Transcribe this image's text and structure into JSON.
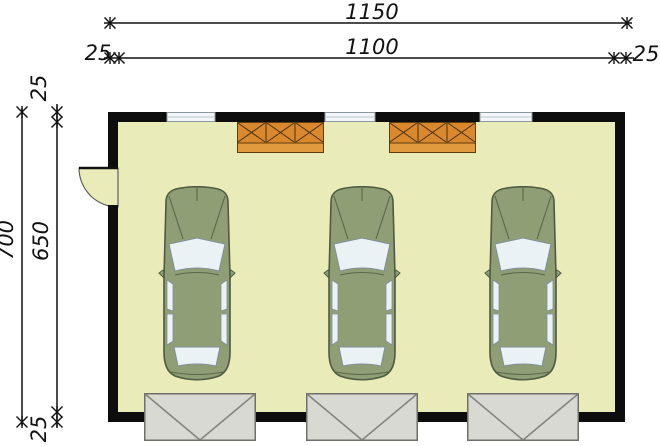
{
  "plan": {
    "type": "garage-floor-plan",
    "dimensions": {
      "width_total": "1150",
      "width_inner": "1100",
      "wall_left": "25",
      "wall_right": "25",
      "height_total": "700",
      "height_inner": "650",
      "wall_top": "25",
      "wall_bottom": "25"
    },
    "colors": {
      "wall": "#0d0d0d",
      "floor": "#e9ecb8",
      "car_body": "#8f9e74",
      "car_glass": "#ebf2f6",
      "cabinet": "#d9882e",
      "cabinet_band": "#e19a3e",
      "garage_door": "#d9d9d4",
      "dimension": "#111111"
    },
    "counts": {
      "cars": 3,
      "garage_doors": 3,
      "windows": 3,
      "cabinets": 2
    }
  }
}
